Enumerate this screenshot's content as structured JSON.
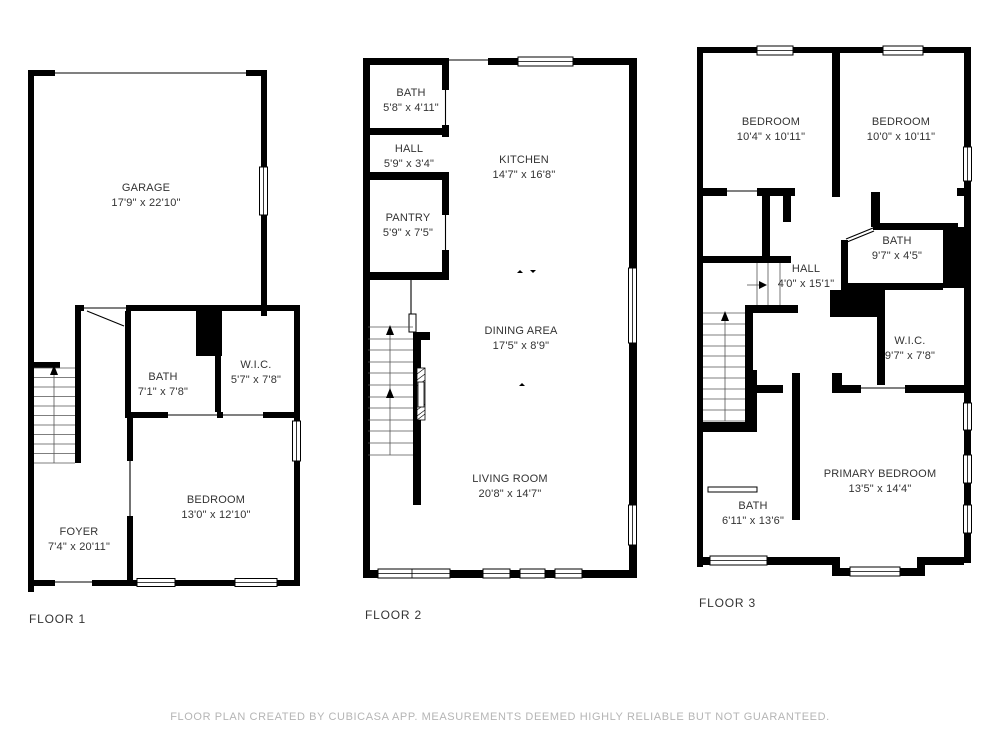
{
  "page": {
    "footer": "FLOOR PLAN CREATED BY CUBICASA APP. MEASUREMENTS DEEMED HIGHLY RELIABLE BUT NOT GUARANTEED."
  },
  "colors": {
    "wall": "#000000",
    "room_text": "#333333",
    "footer_text": "#b5b5b5",
    "background": "#ffffff"
  },
  "floors": [
    {
      "label": "FLOOR 1",
      "rooms": [
        {
          "name": "GARAGE",
          "dims": "17'9\" x 22'10\""
        },
        {
          "name": "BATH",
          "dims": "7'1\" x 7'8\""
        },
        {
          "name": "W.I.C.",
          "dims": "5'7\" x 7'8\""
        },
        {
          "name": "BEDROOM",
          "dims": "13'0\" x 12'10\""
        },
        {
          "name": "FOYER",
          "dims": "7'4\" x 20'11\""
        }
      ]
    },
    {
      "label": "FLOOR 2",
      "rooms": [
        {
          "name": "BATH",
          "dims": "5'8\" x 4'11\""
        },
        {
          "name": "HALL",
          "dims": "5'9\" x 3'4\""
        },
        {
          "name": "PANTRY",
          "dims": "5'9\" x 7'5\""
        },
        {
          "name": "KITCHEN",
          "dims": "14'7\" x 16'8\""
        },
        {
          "name": "DINING AREA",
          "dims": "17'5\" x 8'9\""
        },
        {
          "name": "LIVING ROOM",
          "dims": "20'8\" x 14'7\""
        }
      ]
    },
    {
      "label": "FLOOR 3",
      "rooms": [
        {
          "name": "BEDROOM",
          "dims": "10'4\" x 10'11\""
        },
        {
          "name": "BEDROOM",
          "dims": "10'0\" x 10'11\""
        },
        {
          "name": "BATH",
          "dims": "9'7\" x 4'5\""
        },
        {
          "name": "HALL",
          "dims": "4'0\" x 15'1\""
        },
        {
          "name": "W.I.C.",
          "dims": "9'7\" x 7'8\""
        },
        {
          "name": "PRIMARY BEDROOM",
          "dims": "13'5\" x 14'4\""
        },
        {
          "name": "BATH",
          "dims": "6'11\" x 13'6\""
        }
      ]
    }
  ]
}
